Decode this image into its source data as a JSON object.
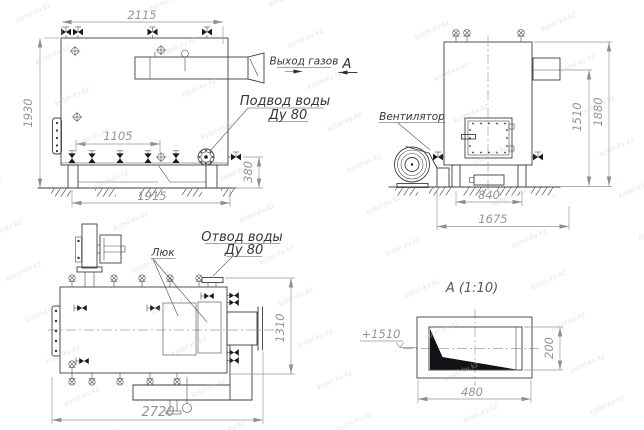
{
  "drawing": {
    "watermark": "kotel-kv.kz",
    "colors": {
      "line": "#3d3d44",
      "dim_line": "#9095a0",
      "dim_text": "#93939d",
      "label_text": "#34353b",
      "centerline": "#97a0ad",
      "fill_dark": "#1a1a1e",
      "watermark": "#c9ced8",
      "background": "#ffffff"
    },
    "side_view": {
      "dim_top": "2115",
      "dim_left": "1930",
      "dim_inner": "1105",
      "dim_bottom": "1915",
      "dim_right": "380",
      "label_gas_out": "Выход газов",
      "label_water_in_1": "Подвод воды",
      "label_water_in_2": "Ду 80",
      "section_mark": "А"
    },
    "front_view": {
      "label_fan": "Вентилятор",
      "dim_h1": "1510",
      "dim_h2": "1880",
      "dim_w1": "840",
      "dim_w2": "1675"
    },
    "plan_view": {
      "label_hatch": "Люк",
      "label_water_out_1": "Отвод воды",
      "label_water_out_2": "Ду 80",
      "dim_length": "2720",
      "dim_width": "1310"
    },
    "detail_a": {
      "title": "А  (1:10)",
      "dim_height": "200",
      "dim_width": "480",
      "level_mark": "+1510"
    }
  }
}
